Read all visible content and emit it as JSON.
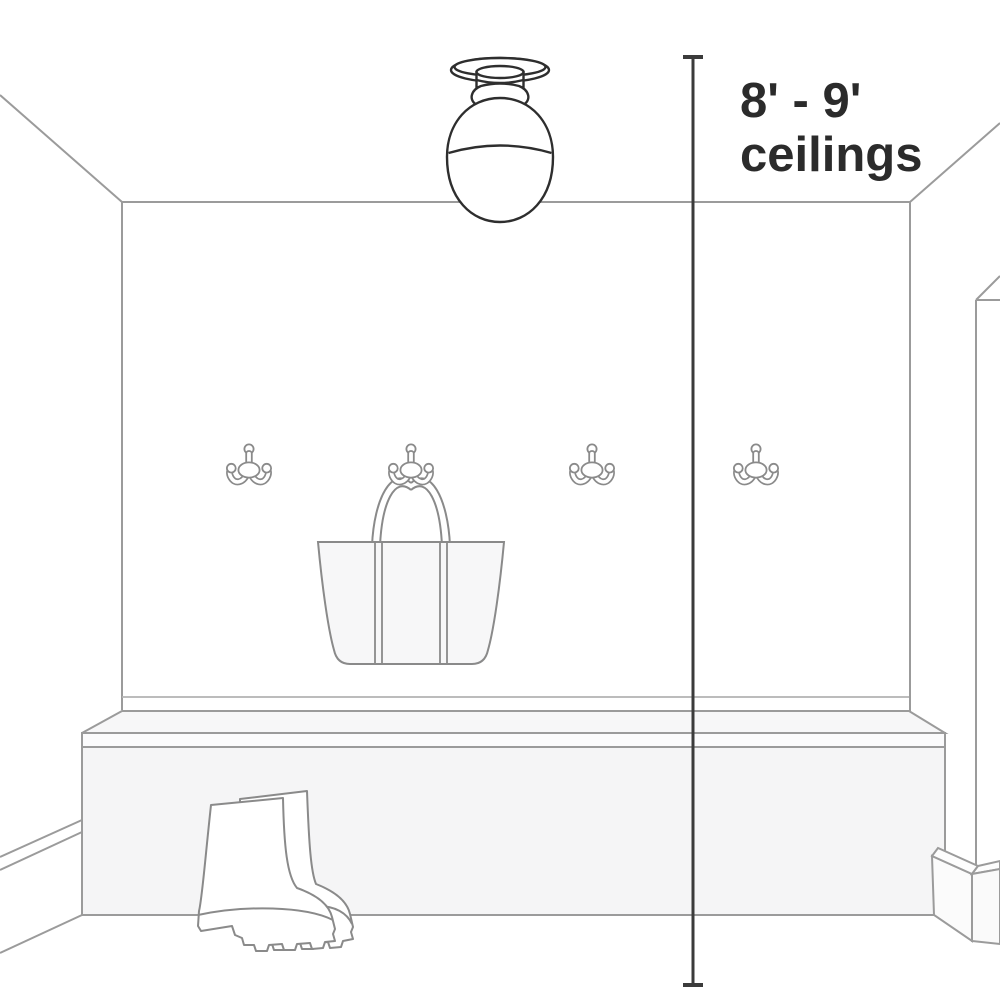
{
  "figure": {
    "caption": {
      "line1": "8' - 9'",
      "line2": "ceilings"
    }
  },
  "scene": {
    "hook_count": 4,
    "objects": [
      "semi-flush-ceiling-light",
      "double-coat-hook",
      "tote-bag",
      "storage-bench",
      "rain-boots"
    ]
  },
  "colors": {
    "background": "#ffffff",
    "room_lines": "#9b9b9b",
    "object_lines": "#8a8a8a",
    "fixture_lines": "#2e2e2e",
    "measure_line": "#3b3b3b",
    "caption_text": "#2b2b2b",
    "panel_fill": "#f5f5f6"
  }
}
